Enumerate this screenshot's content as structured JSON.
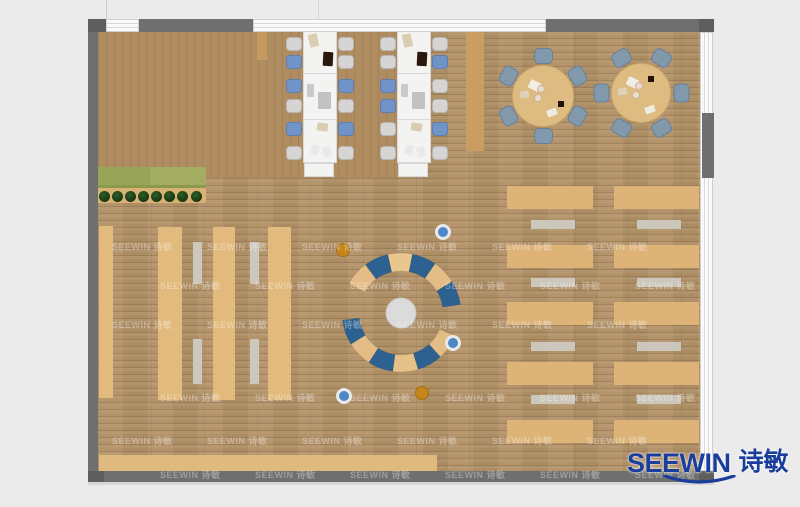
{
  "scene": {
    "width": 800,
    "height": 507,
    "background": "#ebebeb",
    "description": "Top-down rendered floor plan of an open office / library space with wood flooring, desk rows, two long meeting tables, two round tables and a circular lounge seat"
  },
  "branding": {
    "logo_text": "SEEWIN",
    "logo_cjk": "诗敏",
    "logo_color": "#1b3e9c"
  },
  "watermark": {
    "text": "SEEWIN 诗敏",
    "color": "rgba(255,255,255,0.32)",
    "font_size": 9,
    "rows": [
      246,
      285,
      324,
      397,
      440,
      474
    ],
    "row_starts": [
      112,
      160
    ],
    "col_step": 95,
    "col_max": 635
  },
  "floor": {
    "x": 98,
    "y": 32,
    "w": 604,
    "h": 439,
    "patch": {
      "x": 98,
      "y": 32,
      "w": 300,
      "h": 146
    }
  },
  "window_bands": [
    {
      "n": "top-door-gap",
      "x": 106,
      "y": 19,
      "w": 33,
      "h": 13,
      "orient": "h"
    },
    {
      "n": "top-window-band",
      "x": 253,
      "y": 19,
      "w": 293,
      "h": 13,
      "orient": "h"
    },
    {
      "n": "right-window-band",
      "x": 700,
      "y": 32,
      "w": 13,
      "h": 439,
      "orient": "v"
    }
  ],
  "walls": [
    {
      "n": "wall-left",
      "x": 88,
      "y": 19,
      "w": 10,
      "h": 463,
      "f": "#6f6f6f"
    },
    {
      "n": "wall-bottom",
      "x": 88,
      "y": 471,
      "w": 626,
      "h": 11,
      "f": "#6f6f6f"
    },
    {
      "n": "wall-top-left",
      "x": 139,
      "y": 19,
      "w": 114,
      "h": 13,
      "f": "#6f6f6f"
    },
    {
      "n": "wall-top-right",
      "x": 546,
      "y": 19,
      "w": 167,
      "h": 13,
      "f": "#6f6f6f"
    },
    {
      "n": "wall-corner-tl",
      "x": 88,
      "y": 19,
      "w": 18,
      "h": 13,
      "f": "#5e5e5e"
    },
    {
      "n": "wall-corner-tr",
      "x": 699,
      "y": 19,
      "w": 15,
      "h": 13,
      "f": "#5e5e5e"
    },
    {
      "n": "wall-corner-bl",
      "x": 88,
      "y": 471,
      "w": 16,
      "h": 11,
      "f": "#5e5e5e"
    },
    {
      "n": "wall-corner-br",
      "x": 699,
      "y": 471,
      "w": 15,
      "h": 11,
      "f": "#5e5e5e"
    },
    {
      "n": "wall-right-block",
      "x": 702,
      "y": 113,
      "w": 12,
      "h": 65,
      "f": "#6f6f6f"
    },
    {
      "n": "wall-shadow",
      "x": 88,
      "y": 482,
      "w": 626,
      "h": 3,
      "f": "#d7d7d7"
    }
  ],
  "lines": [
    {
      "n": "mullion-line-left",
      "x": 106,
      "y": 0,
      "w": 1,
      "h": 19,
      "f": "#cfcfcf"
    },
    {
      "n": "mullion-line-mid",
      "x": 318,
      "y": 0,
      "w": 1,
      "h": 20,
      "f": "#d8d8d8"
    }
  ],
  "structures": [
    {
      "n": "shelf-row",
      "x": 99,
      "y": 226,
      "w": 14,
      "h": 172,
      "f": "#e3ba7d",
      "streak": true
    },
    {
      "n": "shelf-row",
      "x": 158,
      "y": 227,
      "w": 24,
      "h": 173,
      "f": "#e3ba7d",
      "streak": true
    },
    {
      "n": "shelf-row",
      "x": 213,
      "y": 227,
      "w": 22,
      "h": 173,
      "f": "#e3ba7d",
      "streak": true
    },
    {
      "n": "shelf-row",
      "x": 268,
      "y": 227,
      "w": 23,
      "h": 173,
      "f": "#e3ba7d",
      "streak": true
    },
    {
      "n": "aisle-bench",
      "x": 193,
      "y": 242,
      "w": 9,
      "h": 42,
      "f": "#cdc8bc"
    },
    {
      "n": "aisle-bench",
      "x": 193,
      "y": 339,
      "w": 9,
      "h": 45,
      "f": "#cdc8bc"
    },
    {
      "n": "aisle-bench",
      "x": 250,
      "y": 242,
      "w": 9,
      "h": 42,
      "f": "#cdc8bc"
    },
    {
      "n": "aisle-bench",
      "x": 250,
      "y": 339,
      "w": 9,
      "h": 45,
      "f": "#cdc8bc"
    },
    {
      "n": "desk",
      "x": 507,
      "y": 186,
      "w": 86,
      "h": 23,
      "f": "#ddb377",
      "streak": true
    },
    {
      "n": "desk",
      "x": 507,
      "y": 245,
      "w": 86,
      "h": 23,
      "f": "#ddb377",
      "streak": true
    },
    {
      "n": "desk",
      "x": 507,
      "y": 302,
      "w": 86,
      "h": 23,
      "f": "#ddb377",
      "streak": true
    },
    {
      "n": "desk",
      "x": 507,
      "y": 362,
      "w": 86,
      "h": 23,
      "f": "#ddb377",
      "streak": true
    },
    {
      "n": "desk",
      "x": 507,
      "y": 420,
      "w": 86,
      "h": 23,
      "f": "#ddb377",
      "streak": true
    },
    {
      "n": "desk",
      "x": 614,
      "y": 186,
      "w": 85,
      "h": 23,
      "f": "#ddb377",
      "streak": true
    },
    {
      "n": "desk",
      "x": 614,
      "y": 245,
      "w": 85,
      "h": 23,
      "f": "#ddb377",
      "streak": true
    },
    {
      "n": "desk",
      "x": 614,
      "y": 302,
      "w": 85,
      "h": 23,
      "f": "#ddb377",
      "streak": true
    },
    {
      "n": "desk",
      "x": 614,
      "y": 362,
      "w": 85,
      "h": 23,
      "f": "#ddb377",
      "streak": true
    },
    {
      "n": "desk",
      "x": 614,
      "y": 420,
      "w": 85,
      "h": 23,
      "f": "#ddb377",
      "streak": true
    },
    {
      "n": "desk-bench",
      "x": 531,
      "y": 220,
      "w": 44,
      "h": 9,
      "f": "#ccc7bd"
    },
    {
      "n": "desk-bench",
      "x": 531,
      "y": 278,
      "w": 44,
      "h": 9,
      "f": "#ccc7bd"
    },
    {
      "n": "desk-bench",
      "x": 531,
      "y": 342,
      "w": 44,
      "h": 9,
      "f": "#ccc7bd"
    },
    {
      "n": "desk-bench",
      "x": 531,
      "y": 395,
      "w": 44,
      "h": 9,
      "f": "#ccc7bd"
    },
    {
      "n": "desk-bench",
      "x": 637,
      "y": 220,
      "w": 44,
      "h": 9,
      "f": "#ccc7bd"
    },
    {
      "n": "desk-bench",
      "x": 637,
      "y": 278,
      "w": 44,
      "h": 9,
      "f": "#ccc7bd"
    },
    {
      "n": "desk-bench",
      "x": 637,
      "y": 342,
      "w": 44,
      "h": 9,
      "f": "#ccc7bd"
    },
    {
      "n": "desk-bench",
      "x": 637,
      "y": 395,
      "w": 44,
      "h": 9,
      "f": "#ccc7bd"
    },
    {
      "n": "bottom-bench",
      "x": 99,
      "y": 455,
      "w": 338,
      "h": 16,
      "f": "#dfba7e",
      "streak": true
    },
    {
      "n": "column",
      "x": 257,
      "y": 32,
      "w": 10,
      "h": 28,
      "f": "#c49a61"
    },
    {
      "n": "side-counter",
      "x": 466,
      "y": 32,
      "w": 18,
      "h": 119,
      "f": "#cb9d62"
    }
  ],
  "planter": {
    "green_box": {
      "x": 98,
      "y": 167,
      "w": 108,
      "h": 20,
      "f": "#a3ad61"
    },
    "green_box_left": {
      "x": 98,
      "y": 167,
      "w": 52,
      "h": 20,
      "f": "#98a457"
    },
    "edge": {
      "x": 98,
      "y": 185,
      "w": 108,
      "h": 3,
      "f": "#8a994c"
    },
    "strip": {
      "x": 98,
      "y": 188,
      "w": 108,
      "h": 15,
      "f": "#d8b275"
    },
    "plant_xs": [
      104,
      117,
      130,
      143,
      156,
      169,
      182,
      196
    ],
    "plant_cy": 196,
    "plant_r": 5.5
  },
  "long_tables": {
    "w": 34,
    "h": 132,
    "fill": "#f3f3f2",
    "border": "#d8d8d8",
    "divider_dys": [
      42,
      88
    ],
    "end_unit": {
      "dx": 1,
      "dy": 132,
      "w": 30,
      "h": 14
    },
    "chair": {
      "w": 16,
      "h": 14,
      "dys": [
        6,
        24,
        48,
        68,
        91,
        115
      ],
      "left_dx": -17,
      "right_dx": 35,
      "colors": {
        "gray": "#d6d5d3",
        "blue": "#7094c8"
      },
      "borders": {
        "gray": "#b8b7b4",
        "blue": "#5a7eb3"
      }
    },
    "items": [
      {
        "dx": 6,
        "dy": 3,
        "w": 9,
        "h": 13,
        "f": "#d9cdb2",
        "rot": -12
      },
      {
        "dx": 20,
        "dy": 21,
        "w": 10,
        "h": 14,
        "f": "#2a180d",
        "rot": 3
      },
      {
        "dx": 4,
        "dy": 53,
        "w": 7,
        "h": 13,
        "f": "#c9c9c9",
        "rot": 0
      },
      {
        "dx": 15,
        "dy": 61,
        "w": 13,
        "h": 17,
        "f": "#c2c2c2",
        "rot": 0
      },
      {
        "dx": 14,
        "dy": 92,
        "w": 11,
        "h": 8,
        "f": "#d9cdb2",
        "rot": 8
      },
      {
        "dx": 8,
        "dy": 114,
        "w": 8,
        "h": 10,
        "f": "#e9e9e9",
        "rot": 12
      },
      {
        "dx": 20,
        "dy": 116,
        "w": 8,
        "h": 10,
        "f": "#e9e9e9",
        "rot": -15
      }
    ],
    "tables": [
      {
        "x": 303,
        "y": 31,
        "chairs_left": [
          "gray",
          "blue",
          "blue",
          "gray",
          "blue",
          "gray"
        ],
        "chairs_right": [
          "gray",
          "gray",
          "blue",
          "gray",
          "blue",
          "gray"
        ]
      },
      {
        "x": 397,
        "y": 31,
        "chairs_left": [
          "gray",
          "gray",
          "blue",
          "blue",
          "gray",
          "gray"
        ],
        "chairs_right": [
          "gray",
          "blue",
          "gray",
          "gray",
          "blue",
          "gray"
        ]
      }
    ]
  },
  "round_tables": {
    "fill": "#debb80",
    "border": "#c8a76a",
    "chair": {
      "radius": 40,
      "w": 19,
      "h": 16,
      "fill": "#8199ab",
      "border": "#66809a"
    },
    "tables": [
      {
        "cx": 543,
        "cy": 96,
        "r": 31,
        "chair_angles": [
          90,
          150,
          210,
          270,
          330,
          30
        ],
        "dark_item": {
          "dx": 15,
          "dy": 5
        }
      },
      {
        "cx": 641,
        "cy": 93,
        "r": 30,
        "chair_angles": [
          0,
          60,
          120,
          180,
          240,
          300
        ],
        "dark_item": {
          "dx": 7,
          "dy": -17
        }
      }
    ],
    "items": [
      {
        "dx": -14,
        "dy": -15,
        "w": 11,
        "h": 9,
        "f": "#f1eee7",
        "rot": 25
      },
      {
        "dx": -23,
        "dy": -5,
        "w": 9,
        "h": 7,
        "f": "#ddd2b8",
        "rot": -10
      },
      {
        "dx": 4,
        "dy": 13,
        "w": 10,
        "h": 7,
        "f": "#efece4",
        "rot": -20
      }
    ],
    "plates": [
      {
        "dx": -2,
        "dy": -7
      },
      {
        "dx": -5,
        "dy": 2
      }
    ],
    "plate": {
      "r": 4,
      "f": "#ecdccb",
      "b": "#cbb49a"
    },
    "dark": {
      "w": 6,
      "h": 6,
      "f": "#201208"
    }
  },
  "lounge": {
    "cx": 401,
    "cy": 313,
    "center_circle": {
      "r": 15,
      "f": "#dbdbdb",
      "stroke": "#c9c6c1"
    },
    "arcs": [
      {
        "r1": 42,
        "r2": 60,
        "a0": 150,
        "a1": 8,
        "colors": [
          "#e3bd85",
          "#2d6191",
          "#e9c68e",
          "#2d6191",
          "#e3bd85",
          "#2d6191"
        ]
      },
      {
        "r1": 42,
        "r2": 59,
        "a0": 187,
        "a1": 337,
        "colors": [
          "#2d6191",
          "#e3bd85",
          "#2d6191",
          "#e6c289",
          "#2d6191",
          "#e3bd85"
        ]
      }
    ],
    "dots": [
      {
        "x": 343,
        "y": 250,
        "type": "orange"
      },
      {
        "x": 443,
        "y": 232,
        "type": "blue"
      },
      {
        "x": 453,
        "y": 343,
        "type": "blue"
      },
      {
        "x": 344,
        "y": 396,
        "type": "blue"
      },
      {
        "x": 422,
        "y": 393,
        "type": "orange"
      }
    ],
    "dot_styles": {
      "blue": {
        "r": 8,
        "f": "#4e87c6",
        "ring": "#e9e9e9",
        "ringw": 3
      },
      "orange": {
        "r": 7,
        "f": "#c5861b",
        "ring": "#a86f10",
        "ringw": 1
      }
    }
  }
}
